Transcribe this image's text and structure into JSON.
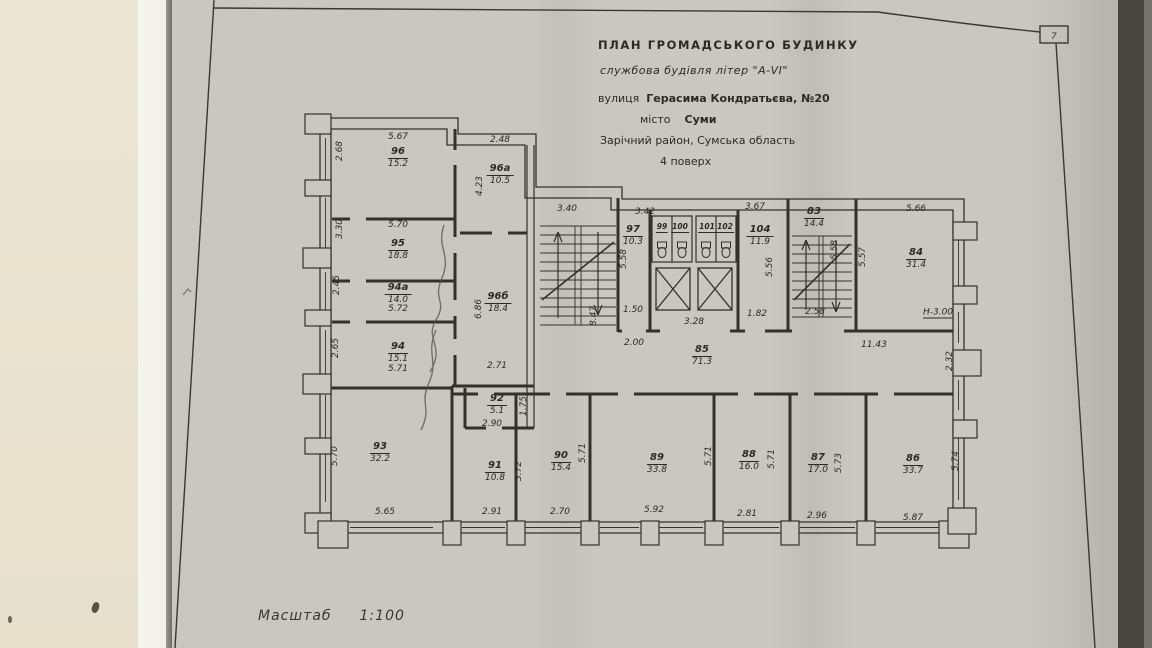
{
  "meta": {
    "corner_mark": "7"
  },
  "title_block": {
    "line1": "ПЛАН  ГРОМАДСЬКОГО  БУДИНКУ",
    "line2": "службова будівля літер \"А-VI\"",
    "street_label": "вулиця",
    "street_value": "Герасима Кондратьєва, №20",
    "city_label": "місто",
    "city_value": "Суми",
    "district": "Зарічний район, Сумська область",
    "floor": "4 поверх"
  },
  "scale": {
    "label": "Масштаб",
    "value": "1:100"
  },
  "rooms": {
    "r96": {
      "num": "96",
      "area": "15.2"
    },
    "r96a": {
      "num": "96а",
      "area": "10.5"
    },
    "r95": {
      "num": "95",
      "area": "18.8"
    },
    "r94a": {
      "num": "94а",
      "area": "14.0"
    },
    "r94": {
      "num": "94",
      "area": "15.1"
    },
    "r96b": {
      "num": "96б",
      "area": "18.4"
    },
    "r92": {
      "num": "92",
      "area": "5.1"
    },
    "r93": {
      "num": "93",
      "area": "32.2"
    },
    "r91": {
      "num": "91",
      "area": "10.8"
    },
    "r90": {
      "num": "90",
      "area": "15.4"
    },
    "r89": {
      "num": "89",
      "area": "33.8"
    },
    "r88": {
      "num": "88",
      "area": "16.0"
    },
    "r87": {
      "num": "87",
      "area": "17.0"
    },
    "r86": {
      "num": "86",
      "area": "33.7"
    },
    "r97": {
      "num": "97",
      "area": "10.3"
    },
    "r99": {
      "num": "99"
    },
    "r100": {
      "num": "100"
    },
    "r101": {
      "num": "101"
    },
    "r102": {
      "num": "102"
    },
    "r104": {
      "num": "104",
      "area": "11.9"
    },
    "r83": {
      "num": "83",
      "area": "14.4"
    },
    "r84": {
      "num": "84",
      "area": "31.4"
    },
    "r85": {
      "num": "85",
      "area": "71.3"
    }
  },
  "dims": {
    "t96": "5.67",
    "t96a": "2.48",
    "t95": "5.70",
    "b94a": "5.72",
    "b94": "5.71",
    "t_stair": "3.40",
    "t97": "3.42",
    "t104": "3.67",
    "t84": "5.66",
    "d271": "2.71",
    "d290": "2.90",
    "b150": "1.50",
    "b328": "3.28",
    "b182": "1.82",
    "b258": "2.58",
    "d200": "2.00",
    "d1143": "11.43",
    "b93": "5.65",
    "b91": "2.91",
    "b90": "2.70",
    "b89": "5.92",
    "b88": "2.81",
    "b87": "2.96",
    "b86": "5.87",
    "v96": "2.68",
    "v95": "3.30",
    "v94a": "2.45",
    "v94": "2.65",
    "v96a": "4.23",
    "v96b": "6.86",
    "v847": "8.47",
    "v97": "5.58",
    "v104": "5.56",
    "v83": "5.58",
    "v84": "5.57",
    "v93": "5.70",
    "v91": "3.72",
    "v90": "5.71",
    "v89": "5.71",
    "v87l": "5.71",
    "v87r": "5.73",
    "v86": "5.74",
    "v232": "2.32",
    "v92": "1.75",
    "elevation": "Н-3.00"
  }
}
